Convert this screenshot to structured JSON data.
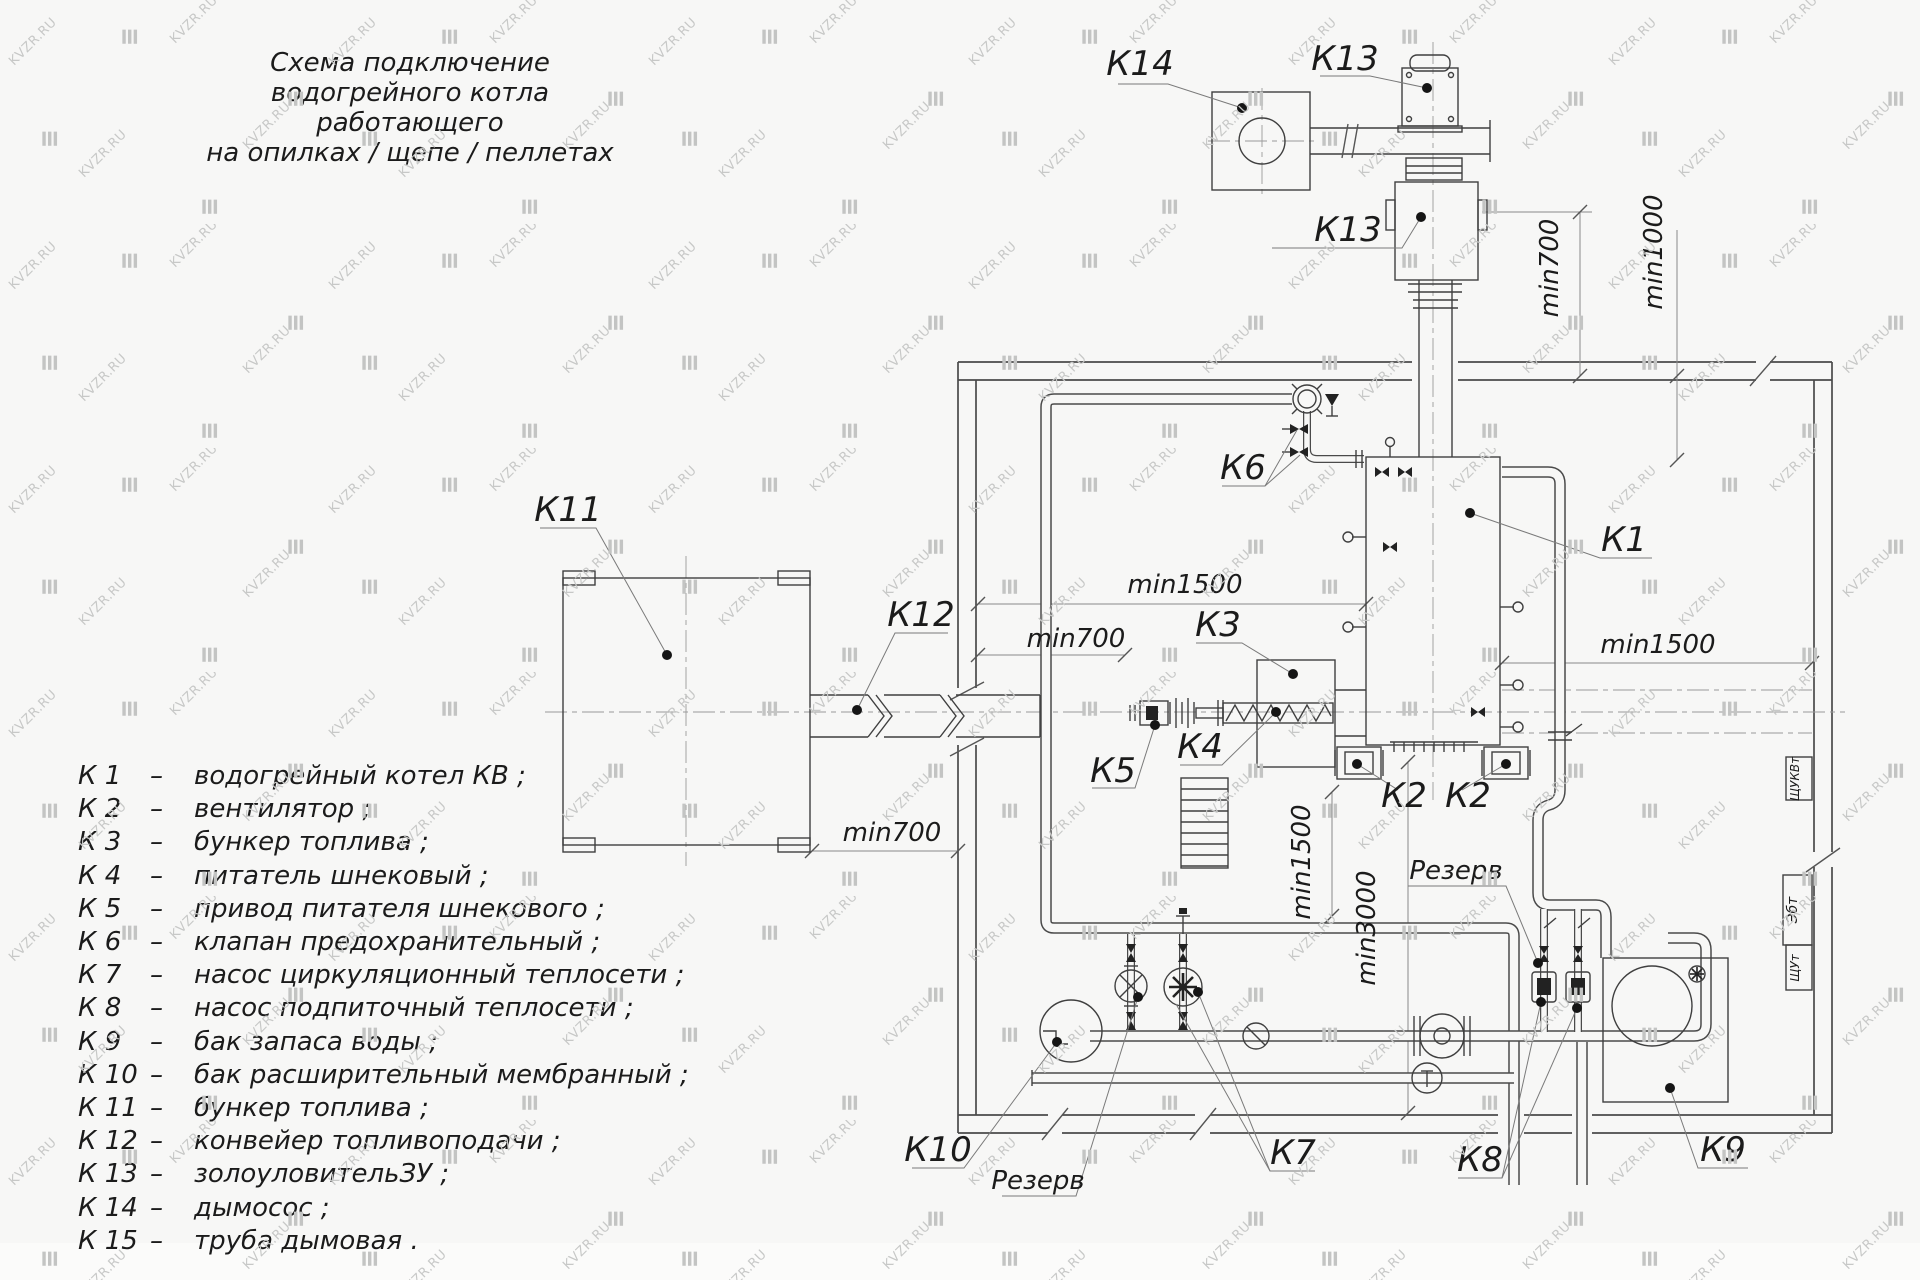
{
  "watermark": {
    "text": "KVZR.RU"
  },
  "title": {
    "lines": [
      "Схема подключение",
      "водогрейного котла работающего",
      "на опилках / щепе / пеллетах"
    ]
  },
  "legend": {
    "separator": "–",
    "items": [
      {
        "key": "К 1",
        "name": "водогрейный котел КВ ;"
      },
      {
        "key": "К 2",
        "name": "вентилятор ;"
      },
      {
        "key": "К 3",
        "name": "бункер топлива ;"
      },
      {
        "key": "К 4",
        "name": "питатель шнековый ;"
      },
      {
        "key": "К 5",
        "name": "привод питателя шнекового ;"
      },
      {
        "key": "К 6",
        "name": "клапан предохранительный ;"
      },
      {
        "key": "К 7",
        "name": "насос циркуляционный теплосети ;"
      },
      {
        "key": "К 8",
        "name": "насос подпиточный теплосети ;"
      },
      {
        "key": "К 9",
        "name": "бак запаса воды ;"
      },
      {
        "key": "К 10",
        "name": "бак расширительный мембранный ;"
      },
      {
        "key": "К 11",
        "name": "бункер топлива ;"
      },
      {
        "key": "К 12",
        "name": "конвейер топливоподачи ;"
      },
      {
        "key": "К 13",
        "name": "золоуловительЗУ ;"
      },
      {
        "key": "К 14",
        "name": "дымосос ;"
      },
      {
        "key": "К 15",
        "name": "труба дымовая ."
      }
    ]
  },
  "diagram": {
    "labels": [
      {
        "id": "k14",
        "text": "К14",
        "x": 1140,
        "y": 75,
        "fs": 34
      },
      {
        "id": "k13-top",
        "text": "К13",
        "x": 1345,
        "y": 70,
        "fs": 34
      },
      {
        "id": "k13-body",
        "text": "К13",
        "x": 1348,
        "y": 241,
        "fs": 34
      },
      {
        "id": "k1",
        "text": "К1",
        "x": 1624,
        "y": 551,
        "fs": 34
      },
      {
        "id": "k6",
        "text": "К6",
        "x": 1243,
        "y": 479,
        "fs": 34
      },
      {
        "id": "k11",
        "text": "К11",
        "x": 568,
        "y": 521,
        "fs": 34
      },
      {
        "id": "k12",
        "text": "К12",
        "x": 921,
        "y": 626,
        "fs": 34
      },
      {
        "id": "k3",
        "text": "К3",
        "x": 1218,
        "y": 636,
        "fs": 34
      },
      {
        "id": "k4",
        "text": "К4",
        "x": 1200,
        "y": 758,
        "fs": 34
      },
      {
        "id": "k5",
        "text": "К5",
        "x": 1113,
        "y": 782,
        "fs": 34
      },
      {
        "id": "k2-left",
        "text": "К2",
        "x": 1404,
        "y": 807,
        "fs": 34
      },
      {
        "id": "k2-right",
        "text": "К2",
        "x": 1468,
        "y": 807,
        "fs": 34
      },
      {
        "id": "k7",
        "text": "К7",
        "x": 1293,
        "y": 1164,
        "fs": 34
      },
      {
        "id": "k8",
        "text": "К8",
        "x": 1480,
        "y": 1171,
        "fs": 34
      },
      {
        "id": "k9",
        "text": "К9",
        "x": 1723,
        "y": 1161,
        "fs": 34
      },
      {
        "id": "k10",
        "text": "К10",
        "x": 938,
        "y": 1161,
        "fs": 34
      },
      {
        "id": "rezerv-top",
        "text": "Резерв",
        "x": 1456,
        "y": 879,
        "fs": 26
      },
      {
        "id": "rezerv-bottom",
        "text": "Резерв",
        "x": 1038,
        "y": 1189,
        "fs": 26
      },
      {
        "id": "dim-1500-mid",
        "text": "min1500",
        "x": 1185,
        "y": 593,
        "fs": 26
      },
      {
        "id": "dim-700-mid",
        "text": "min700",
        "x": 1076,
        "y": 647,
        "fs": 26
      },
      {
        "id": "dim-1500-right",
        "text": "min1500",
        "x": 1658,
        "y": 653,
        "fs": 26
      },
      {
        "id": "dim-700-bunker",
        "text": "min700",
        "x": 892,
        "y": 841,
        "fs": 26
      },
      {
        "id": "dim-700-top",
        "text": "min700",
        "x": 1558,
        "y": 268,
        "fs": 26,
        "rot": -90
      },
      {
        "id": "dim-1000-top",
        "text": "min1000",
        "x": 1662,
        "y": 252,
        "fs": 26,
        "rot": -90
      },
      {
        "id": "dim-1500-vert",
        "text": "min1500",
        "x": 1310,
        "y": 862,
        "fs": 26,
        "rot": -90
      },
      {
        "id": "dim-3000-vert",
        "text": "min3000",
        "x": 1375,
        "y": 928,
        "fs": 26,
        "rot": -90
      },
      {
        "id": "cabinet-shukvt",
        "text": "ЩУКВт",
        "x": 1799,
        "y": 779,
        "fs": 12,
        "rot": -90
      },
      {
        "id": "cabinet-ebt",
        "text": "Эбт",
        "x": 1797,
        "y": 910,
        "fs": 14,
        "rot": -90
      },
      {
        "id": "cabinet-shut",
        "text": "ЩУт",
        "x": 1799,
        "y": 968,
        "fs": 12,
        "rot": -90
      }
    ]
  }
}
